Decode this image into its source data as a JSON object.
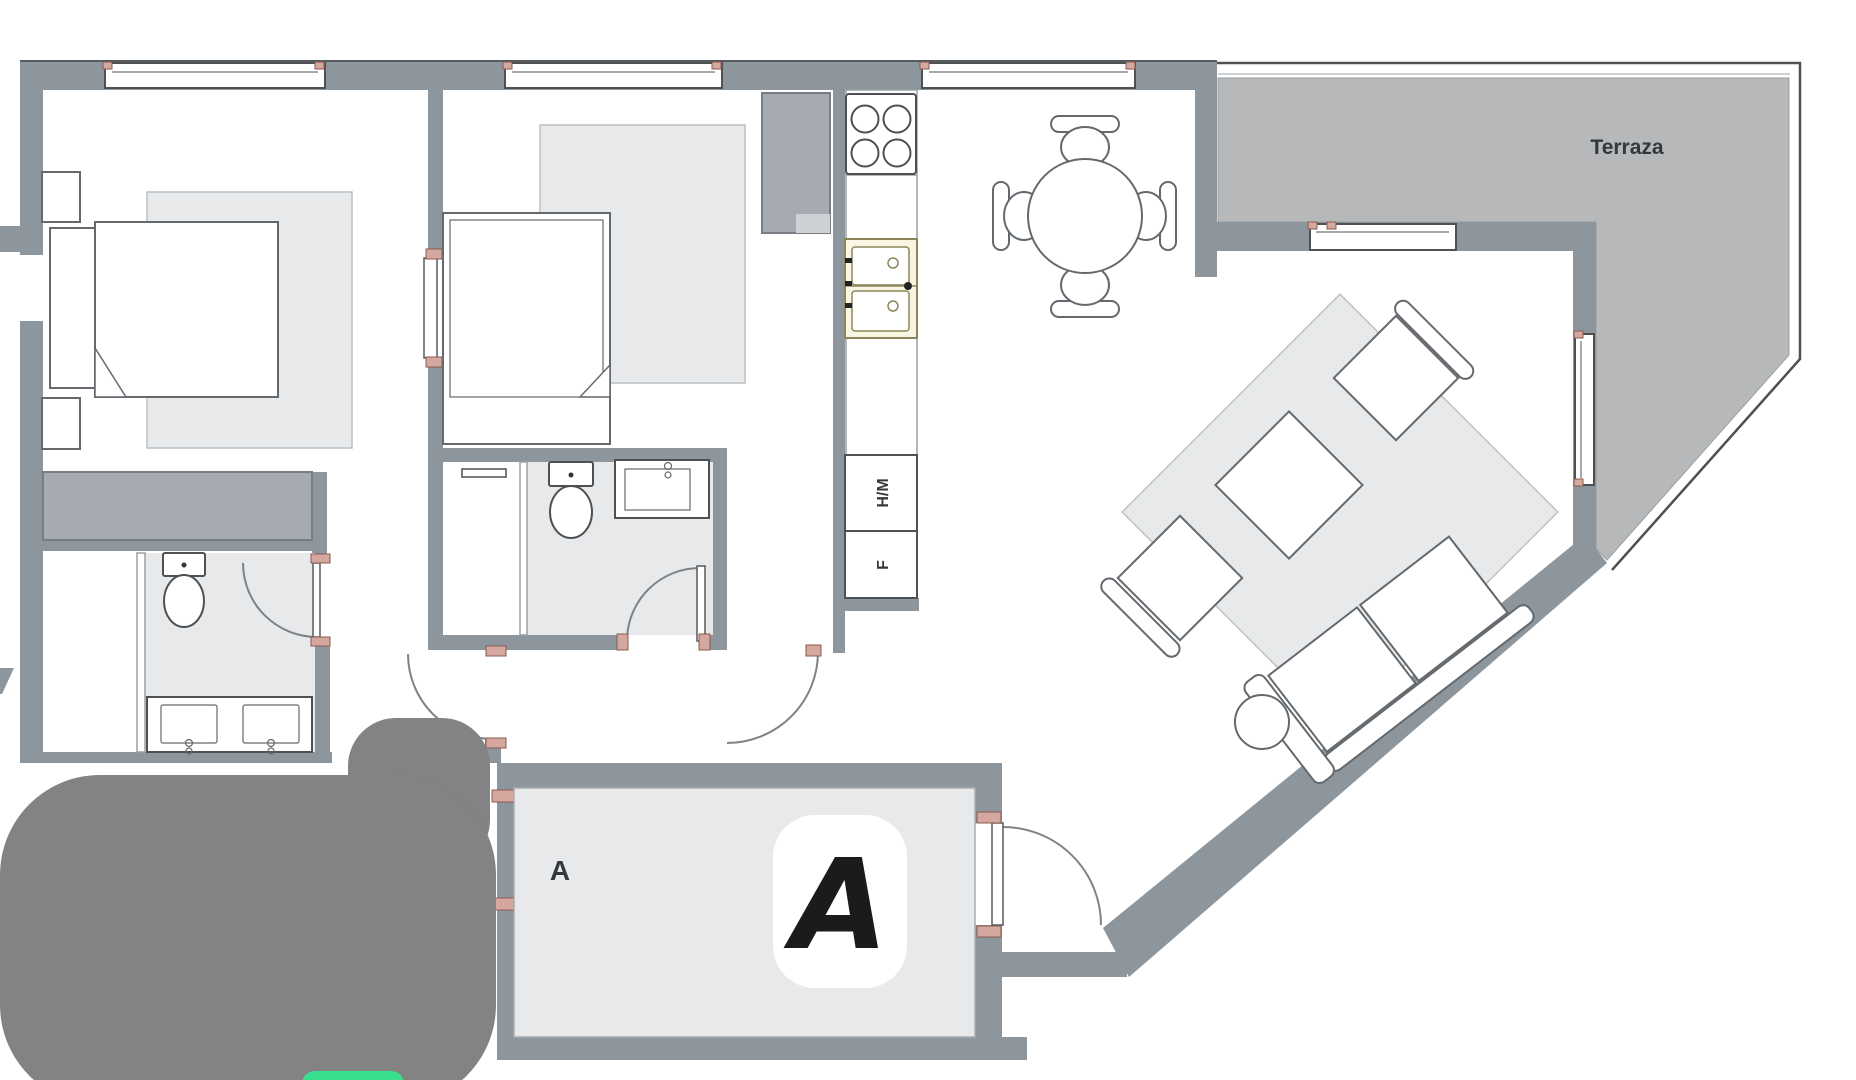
{
  "plan": {
    "terrace_label": "Terraza",
    "appliance_washer": "H/M",
    "appliance_fridge": "F",
    "zone_label": "A",
    "zone_badge": "A"
  },
  "colors": {
    "wall": "#8d969d",
    "terrace-floor": "#b6b8ba",
    "rug": "#e8e9eb",
    "rug-line": "#bcc1c4",
    "furn-line": "#64696e",
    "closet": "#a5abb0",
    "closet-line": "#777d82",
    "outline": "#4d5154",
    "sink-fill": "#f9f5e3",
    "sink-line": "#8c855a",
    "jamb": "#d4a89e",
    "jamb-line": "#8a5a50",
    "door-arc": "#7e8287",
    "blob": "#838383",
    "green": "#38e08e",
    "text": "#34383c",
    "glyph": "#1b1b1b"
  }
}
